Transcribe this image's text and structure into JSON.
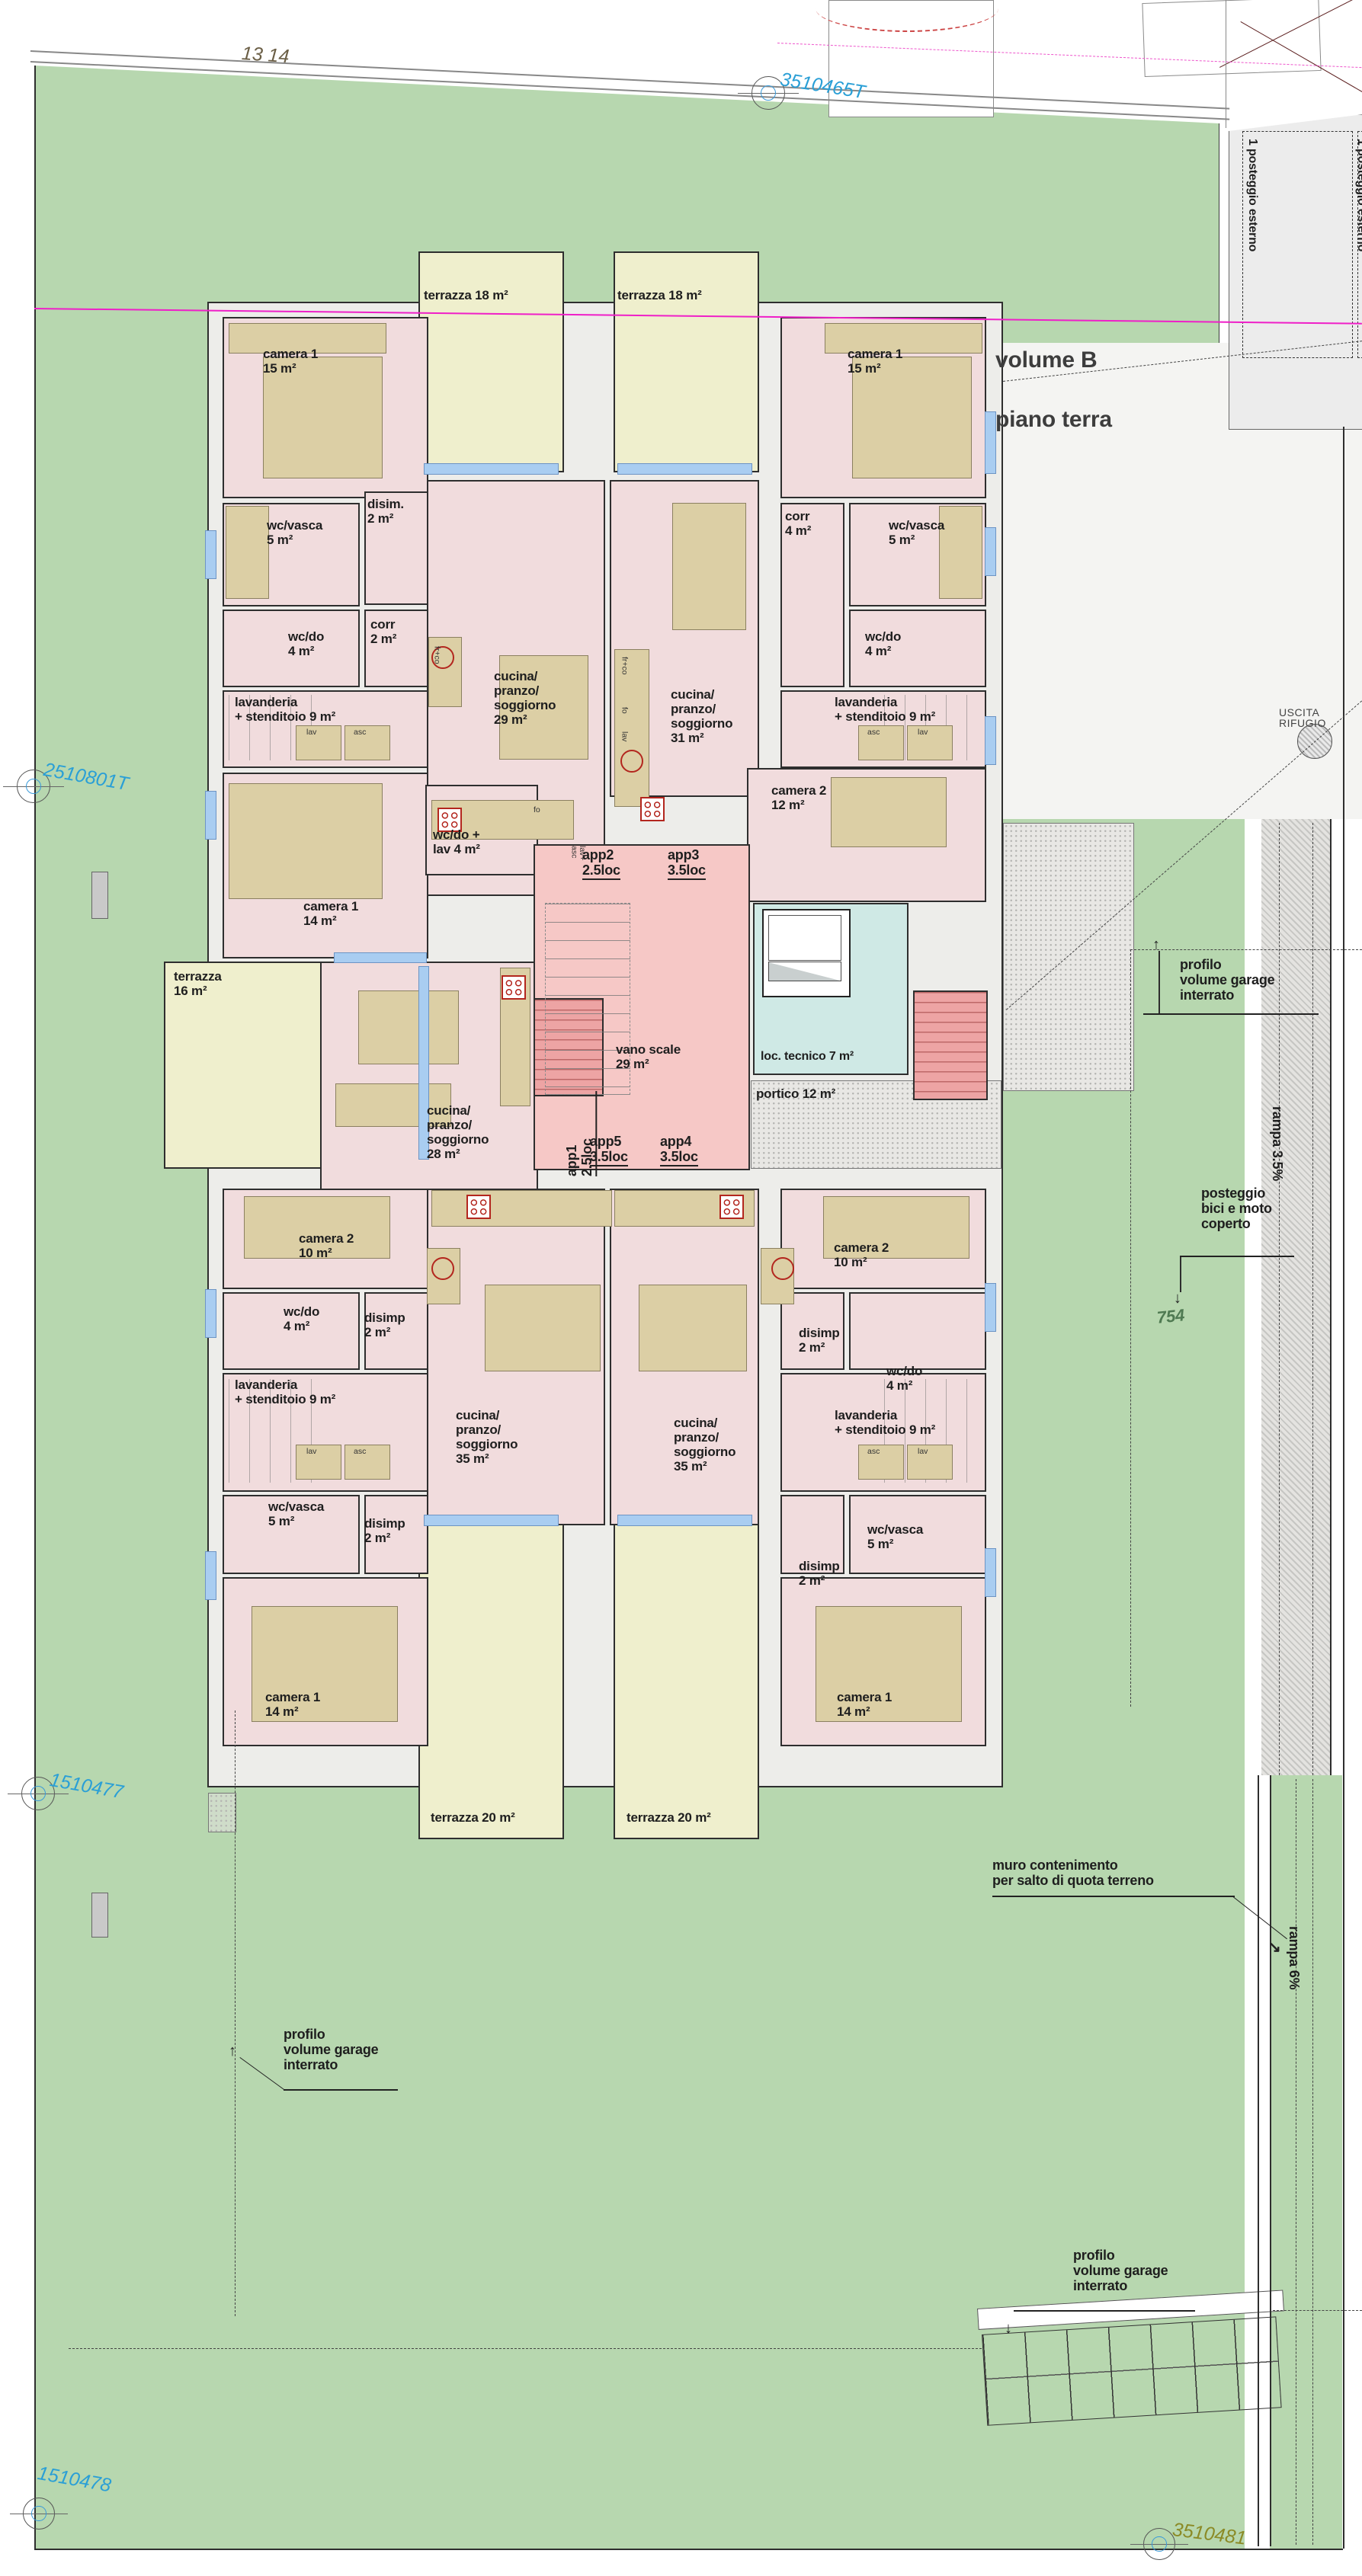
{
  "title": {
    "line1": "volume B",
    "line2": "piano terra"
  },
  "markers": {
    "top": "3510465T",
    "left": "2510801T",
    "mid_left": "1510477",
    "bottom_left": "1510478",
    "bottom_right": "3510481",
    "plot_numbers": "13  14",
    "parcel_number": "754"
  },
  "site": {
    "posteggio_esterno": "1 posteggio esterno",
    "uscita_rifugio": "USCITA RIFUGIO",
    "rampa_35": "rampa 3.5%",
    "rampa_6": "rampa 6%",
    "posteggio_bici": "posteggio\nbici e moto\ncoperto",
    "muro": "muro contenimento\nper salto di quota terreno",
    "profilo_garage": "profilo\nvolume garage\ninterrato"
  },
  "apartments": {
    "app1": "app1\n2.5loc",
    "app2": "app2\n2.5loc",
    "app3": "app3\n3.5loc",
    "app4": "app4\n3.5loc",
    "app5": "app5\n3.5loc"
  },
  "rooms": {
    "terrazza18": "terrazza 18 m²",
    "terrazza20": "terrazza 20 m²",
    "terrazza16": "terrazza\n16 m²",
    "camera1_15": "camera 1\n15 m²",
    "camera1_14": "camera 1\n14 m²",
    "camera2_12": "camera 2\n12 m²",
    "camera2_10": "camera 2\n10 m²",
    "disim": "disim.\n2 m²",
    "disimp": "disimp\n2 m²",
    "corr2": "corr\n2 m²",
    "corr4": "corr\n4 m²",
    "wcvasca": "wc/vasca\n5 m²",
    "wcdo": "wc/do\n4 m²",
    "wcdolav": "wc/do +\nlav 4 m²",
    "lavanderia": "lavanderia\n+ stenditoio 9 m²",
    "cucina29": "cucina/\npranzo/\nsoggiorno\n29 m²",
    "cucina31": "cucina/\npranzo/\nsoggiorno\n31 m²",
    "cucina28": "cucina/\npranzo/\nsoggiorno\n28 m²",
    "cucina35": "cucina/\npranzo/\nsoggiorno\n35 m²",
    "vano_scale": "vano scale\n29 m²",
    "loc_tecnico": "loc. tecnico 7 m²",
    "portico": "portico 12 m²"
  },
  "mini": {
    "lav": "lav",
    "asc": "asc",
    "fo": "fo",
    "frco": "fr+co",
    "lavasc": "lav+\nasc"
  },
  "colors": {
    "grass": "#b7d7af",
    "room_pink": "#f1dcdd",
    "hall_red": "#f6c8c6",
    "terrace_yellow": "#efefcd",
    "furniture_tan": "#dccfa5",
    "window_blue": "#a9cdf1",
    "tech_cyan": "#cfe9e5",
    "magenta_line": "#ef1fc8",
    "survey_blue": "#2a9fd6",
    "parking_gray": "#ececec",
    "marker_olive": "#8b8a26"
  }
}
